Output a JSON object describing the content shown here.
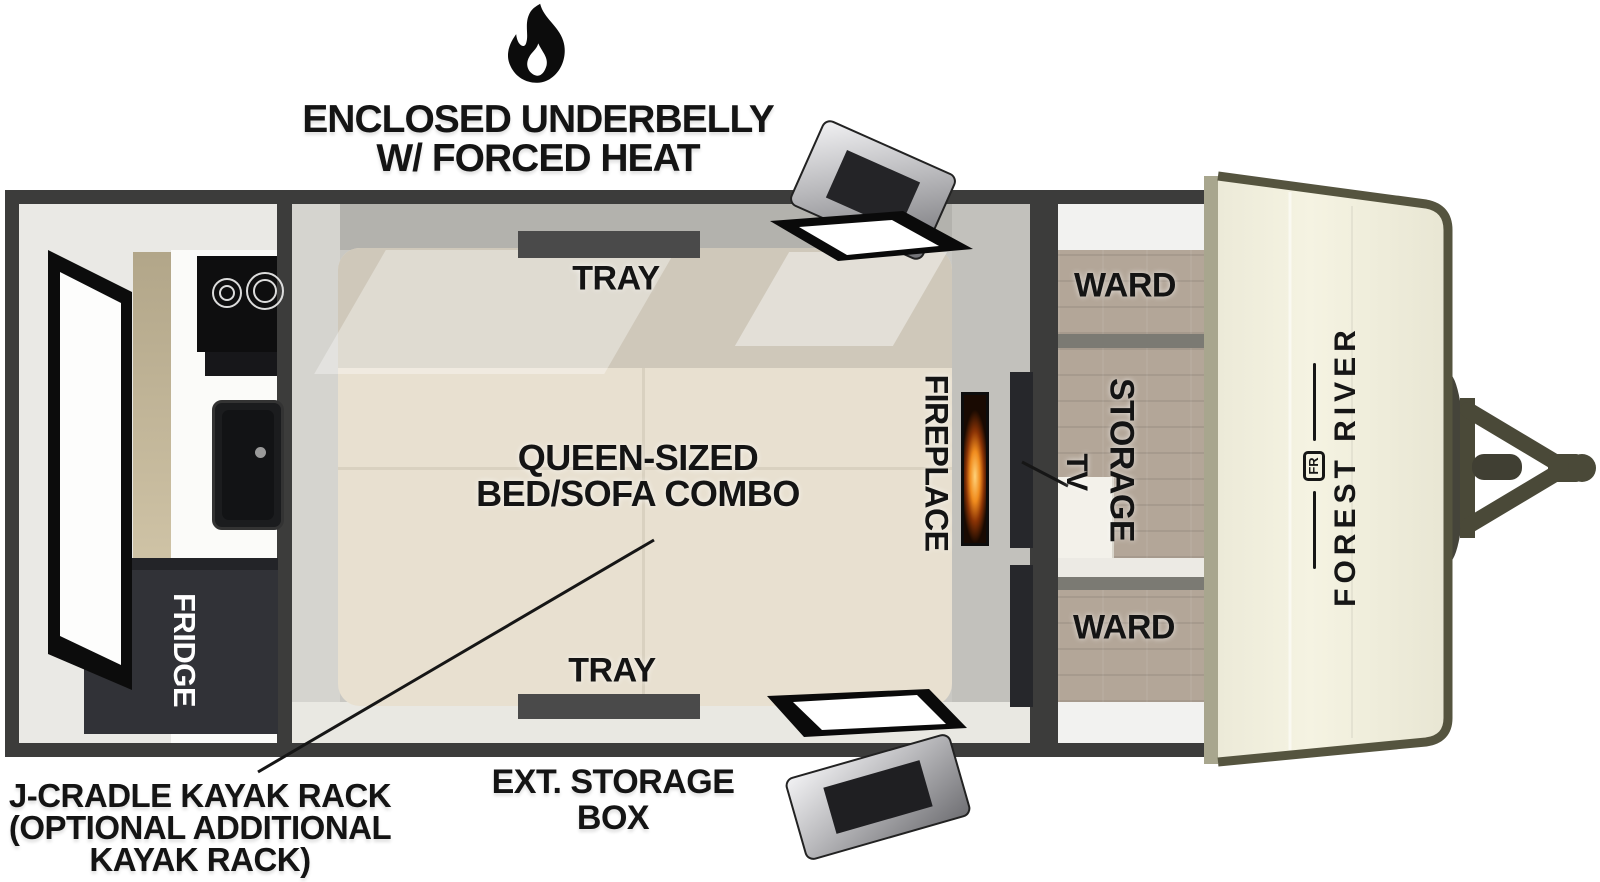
{
  "diagram_title": {
    "line1": "ENCLOSED UNDERBELLY",
    "line2": "W/ FORCED HEAT"
  },
  "rooms": {
    "tray_top": "TRAY",
    "tray_bottom": "TRAY",
    "bed_line1": "QUEEN-SIZED",
    "bed_line2": "BED/SOFA COMBO",
    "fireplace": "FIREPLACE",
    "tv": "TV",
    "storage": "STORAGE",
    "ward_top": "WARD",
    "ward_bottom": "WARD",
    "fridge": "FRIDGE"
  },
  "brand": {
    "name": "FOREST RIVER",
    "logo_monogram": "FR"
  },
  "annotations": {
    "kayak_line1": "J-CRADLE KAYAK RACK",
    "kayak_line2": "(OPTIONAL ADDITIONAL",
    "kayak_line3": "KAYAK RACK)",
    "ext_storage_line1": "EXT. STORAGE",
    "ext_storage_line2": "BOX"
  },
  "icons": {
    "heat": "flame-icon",
    "hitch": "a-frame-hitch-icon",
    "doors": [
      "rear-entry-door",
      "top-cargo-door",
      "bottom-cargo-door"
    ],
    "appliances": [
      "cooktop",
      "sink",
      "fridge",
      "fireplace",
      "tv"
    ]
  },
  "colors": {
    "wall": "#3c3c3b",
    "tray": "#4a4a4a",
    "bed": "#e8e0d0",
    "bed_back": "#cfc8ba",
    "floor": "#e9e8e2",
    "wood": "#b3a698",
    "cap": "#f1efdc",
    "cap_trim": "#55543f",
    "hitch": "#4a4938",
    "flame_orange": "#f08c1e",
    "text": "#141414"
  }
}
